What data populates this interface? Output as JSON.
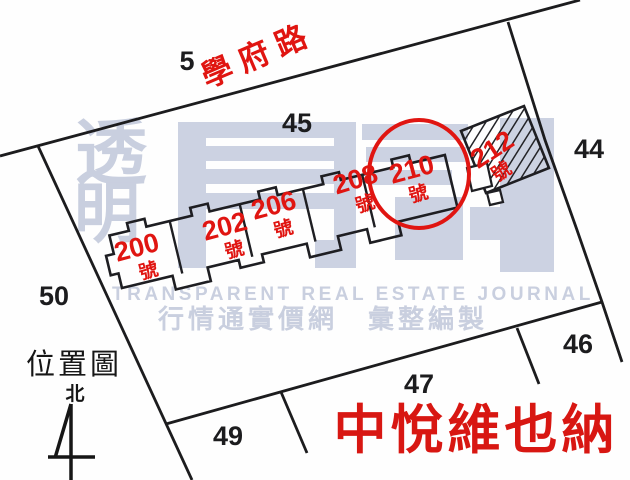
{
  "map": {
    "road_label": "學府路",
    "lots": [
      {
        "text": "5"
      },
      {
        "text": "45"
      },
      {
        "text": "44"
      },
      {
        "text": "50"
      },
      {
        "text": "49"
      },
      {
        "text": "47"
      },
      {
        "text": "46"
      }
    ],
    "units": [
      {
        "number": "200",
        "suffix": "號"
      },
      {
        "number": "202",
        "suffix": "號"
      },
      {
        "number": "206",
        "suffix": "號"
      },
      {
        "number": "208",
        "suffix": "號"
      },
      {
        "number": "210",
        "suffix": "號"
      },
      {
        "number": "212",
        "suffix": "號"
      }
    ],
    "highlighted_unit": "210",
    "legend": {
      "location_map_label": "位置圖",
      "north_label": "北"
    },
    "building_name": "中悅維也納"
  },
  "watermark": {
    "vertical_chars": [
      "透",
      "明"
    ],
    "journal_text": "TRANSPARENT REAL ESTATE JOURNAL",
    "tagline": "行情通實價網　彙整編製"
  },
  "colors": {
    "accent_red": "#e01511",
    "line_black": "#1c1c1e",
    "watermark_gray": "#ccd2e2"
  }
}
